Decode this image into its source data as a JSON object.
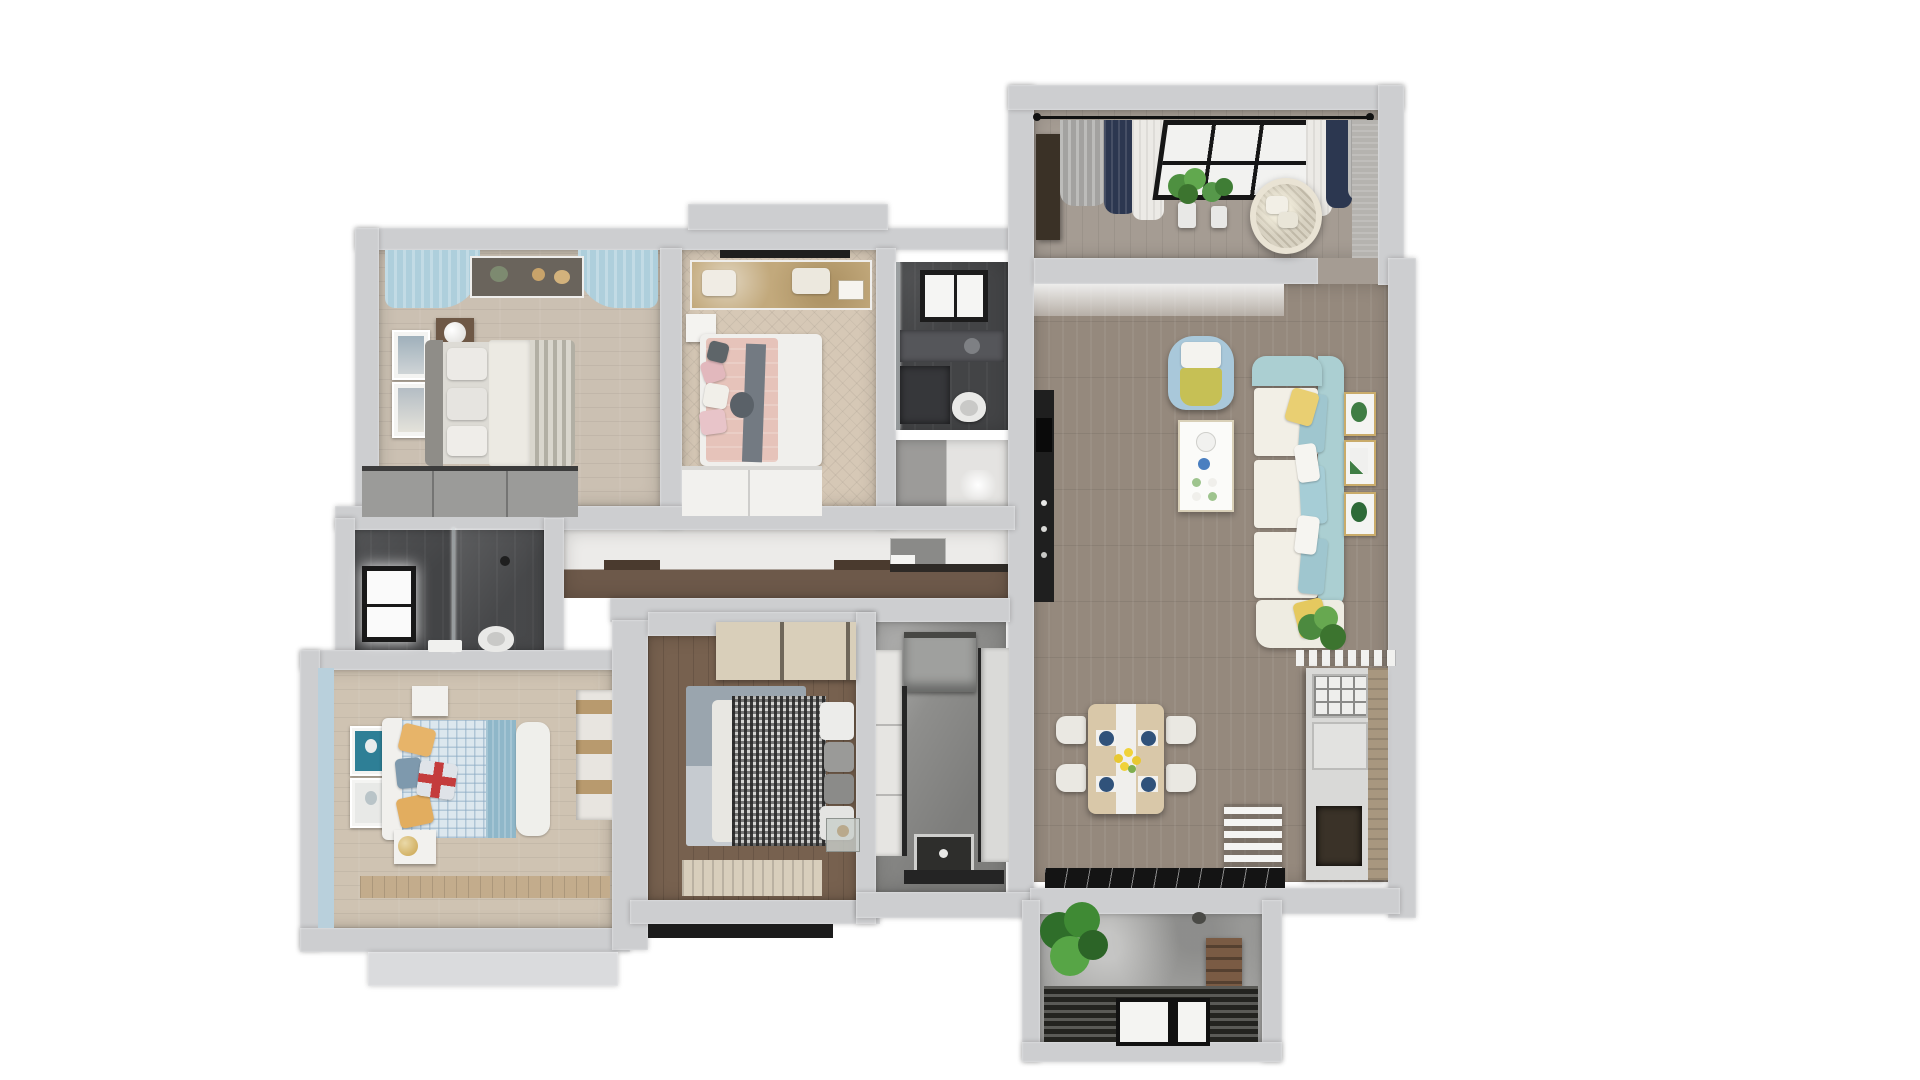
{
  "scene": {
    "title": "Top-down 3D render of an apartment floor plan",
    "background": "#ffffff",
    "visible_text": "none"
  },
  "palette": {
    "wall": "#cdced0",
    "floorLight": "#cbc0b2",
    "floorHerringbone": "#d8cbb9",
    "floorBlueBedroom": "#cfc3b2",
    "floorDark": "#77614f",
    "floorLiving": "#95897d",
    "floorBalcony": "#a59c93",
    "corridorWood": "#6d594a",
    "bathDark": "#434446",
    "kitchenMarble": "#8e8e8c",
    "sofaSeafoam": "#abcfd2",
    "cushionWhite": "#f2efe6",
    "accentYellow": "#e9cf72",
    "armchairBlue": "#a9c8da",
    "armchairSeat": "#c6c055",
    "curtainBlue": "#aecfdc",
    "curtainNavy": "#2c3750",
    "curtainGray": "#a3a2a0",
    "bedPink": "#e6c3ba",
    "plaidDark": "#3a3a3a",
    "duvetBlueCheck": "#dce7ee",
    "tableWood": "#d9c8a9",
    "plateBlue": "#30527a",
    "plantGreen": "#4e9040",
    "frameGold": "#c9ab6a",
    "entryMarble": "#141414",
    "wardrobeTan": "#d9cfba",
    "unionJackRed": "#c43c3c",
    "blueWall": "#b9d0dc"
  },
  "rooms": [
    {
      "id": "bedroom-top-left",
      "label": "Bedroom with gray striped bedding",
      "furniture": [
        "gray-headboard-bed",
        "striped-duvet",
        "dark-nightstand",
        "sphere-lamp",
        "wall-art-frames",
        "blue-curtains",
        "window-shelf-decor",
        "gray-wardrobe"
      ]
    },
    {
      "id": "bedroom-pink",
      "label": "Bedroom with pink bedding",
      "furniture": [
        "white-frame-bed",
        "pink-duvet",
        "gray-throw",
        "accent-pillows",
        "window-desk",
        "white-nightstand",
        "white-dresser"
      ]
    },
    {
      "id": "bathroom-top",
      "label": "Bathroom with window",
      "furniture": [
        "window",
        "vanity-counter",
        "toilet",
        "glass-partition"
      ]
    },
    {
      "id": "shower-room",
      "label": "Small shower room",
      "furniture": [
        "marble-shower",
        "glass-front"
      ]
    },
    {
      "id": "hallway",
      "label": "Hallway",
      "furniture": [
        "dark-wood-floor",
        "wall-cabinet",
        "shelf"
      ]
    },
    {
      "id": "bathroom-left",
      "label": "Bathroom with glass shower",
      "furniture": [
        "bright-window",
        "glass-shower",
        "toilet",
        "towel"
      ]
    },
    {
      "id": "bedroom-blue",
      "label": "Blue kids bedroom",
      "furniture": [
        "white-headboard-bed",
        "blue-checked-duvet",
        "union-jack-pillow",
        "yellow-pillows",
        "balloon-posters",
        "white-nightstands",
        "gold-lamp",
        "built-in-wardrobe"
      ]
    },
    {
      "id": "bedroom-dark",
      "label": "Bedroom with houndstooth bedding",
      "furniture": [
        "plaid-duvet-bed",
        "stacked-pillows",
        "blue-gray-rug",
        "tan-wardrobe",
        "glass-side-table",
        "slatted-mat"
      ]
    },
    {
      "id": "kitchen",
      "label": "Galley kitchen",
      "furniture": [
        "range-hood",
        "tall-cabinet",
        "counters",
        "sink",
        "marble-floor"
      ]
    },
    {
      "id": "living-room",
      "label": "Living room",
      "furniture": [
        "seafoam-l-sofa",
        "white-seat-cushions",
        "yellow-accent-pillows",
        "blue-armchair",
        "white-coffee-table",
        "botanical-gallery-wall",
        "black-kitchenette-counter",
        "ledge-plant"
      ]
    },
    {
      "id": "dining-area",
      "label": "Dining area and entry",
      "furniture": [
        "wood-dining-table",
        "white-table-runner",
        "four-white-chairs",
        "blue-place-settings",
        "yellow-flower-centerpiece",
        "white-slat-divider",
        "entry-cabinet",
        "dark-marble-entry-floor"
      ]
    },
    {
      "id": "balcony-top",
      "label": "Enclosed balcony lounge",
      "furniture": [
        "curtain-rod",
        "gray-navy-sheer-curtains",
        "black-frame-window",
        "potted-plants",
        "hanging-egg-chair",
        "dark-cabinet"
      ]
    },
    {
      "id": "balcony-bottom",
      "label": "Service balcony",
      "furniture": [
        "large-potted-plant",
        "marble-wall",
        "slatted-floor-grate",
        "window-insert",
        "wooden-crate"
      ]
    }
  ]
}
